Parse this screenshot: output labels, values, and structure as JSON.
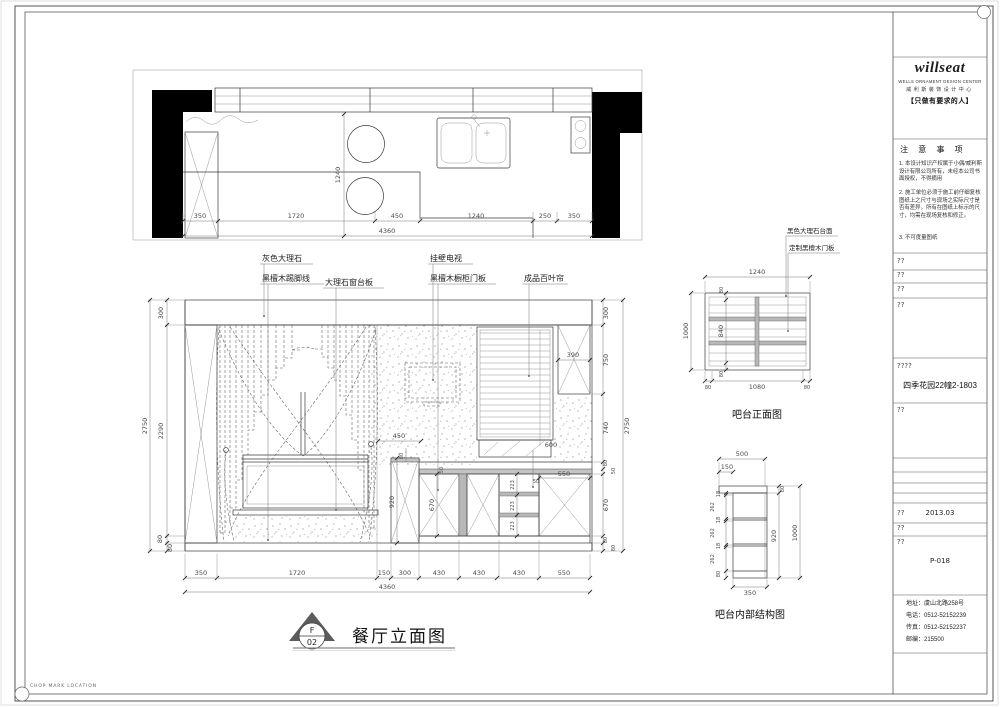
{
  "sheet": {
    "chop_mark": "CHOP MARK LOCATION"
  },
  "plan": {
    "dims_bottom": [
      "350",
      "1720",
      "450",
      "1240",
      "250",
      "350"
    ],
    "dim_total": "4360",
    "dim_depth": "1240"
  },
  "elevation": {
    "labels": {
      "gray_marble": "灰色大理石",
      "skirting": "黑檀木踢脚线",
      "sill": "大理石窗台板",
      "tv": "挂壁电视",
      "cabinet_door": "黑檀木橱柜门板",
      "blinds": "成品百叶帘"
    },
    "dims_left": [
      "300",
      "2290",
      "80",
      "80"
    ],
    "dims_right": [
      "300",
      "750",
      "740",
      "80",
      "50",
      "670",
      "80",
      "80"
    ],
    "dims_bottom": [
      "350",
      "1720",
      "150",
      "300",
      "430",
      "430",
      "430",
      "550"
    ],
    "dim_total_h": "4360",
    "dim_total_v": "2750",
    "dims_inner": {
      "niche_w": "450",
      "niche_h": "80",
      "partition": "920",
      "door_h": "670",
      "counter": "50",
      "drawers": [
        "223",
        "223",
        "223"
      ],
      "drawer_top": "50",
      "door_w": "550",
      "sill_w": "600",
      "panel_w": "390"
    },
    "marker_letter": "F",
    "marker_number": "02",
    "title": "餐厅立面图"
  },
  "bar_front": {
    "label_top": "黑色大理石台面",
    "label_door": "定制黑檀木门板",
    "dim_width": "1240",
    "dim_height": "1000",
    "dims_v": [
      "80",
      "840",
      "80"
    ],
    "dims_bottom": [
      "80",
      "1080",
      "80"
    ],
    "title": "吧台正面图"
  },
  "bar_section": {
    "dim_top": "500",
    "dim_overhang": "150",
    "dims_left": [
      "18",
      "262",
      "18",
      "262",
      "18",
      "262",
      "80"
    ],
    "dim_inner_h": "920",
    "dim_height": "1000",
    "dim_slab": "80",
    "dim_bottom": "350",
    "title": "吧台内部结构图"
  },
  "titleblock": {
    "logo_word": "willseat",
    "logo_line1": "WELLS ORNAMENT DESIGN CENTER",
    "logo_line2": "威利斯装饰设计中心",
    "logo_slogan": "【只做有要求的人】",
    "notes_title": "注 意 事 项",
    "note1": "1. 本设计知识产权属于小偶/威利斯设计有限公司所有，未经本公司书面授权，不得摘用",
    "note2": "2. 施工单位必须于施工前仔细复核图纸上之尺寸与现场之实际尺寸是否有差异，所有在图纸上标示的尺寸，均需在现场复核和修正。",
    "note3": "3. 不可度量图纸",
    "ph1": "??",
    "ph2": "??",
    "ph3": "??",
    "ph4": "??",
    "proj_label": "????",
    "project": "四季花园22幢2-1803",
    "ph5": "??",
    "date_label": "??",
    "date": "2013.03",
    "ph6": "??",
    "no_label": "??",
    "drawing_no": "P-018",
    "address": "地址：虞山北路258号",
    "phone": "电话：0512-52152239",
    "fax": "传真：0512-52152237",
    "postal": "邮编：215500"
  }
}
